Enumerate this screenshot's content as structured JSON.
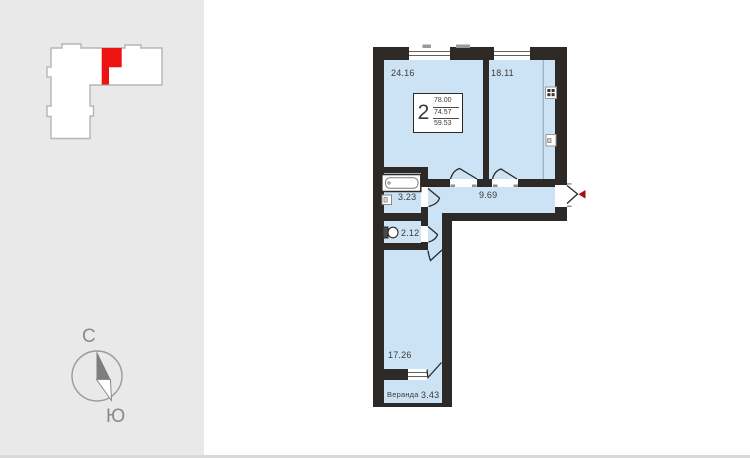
{
  "sidebar": {
    "compass": {
      "north": "С",
      "south": "Ю"
    }
  },
  "info_box": {
    "rooms_count": "2",
    "areas": [
      "78.00",
      "74.57",
      "59.53"
    ]
  },
  "rooms": {
    "living": "24.16",
    "kitchen": "18.11",
    "hall": "9.69",
    "bath": "3.23",
    "wc": "2.12",
    "bedroom": "17.26",
    "veranda_label": "Веранда",
    "veranda_area": "3.43"
  },
  "colors": {
    "wall": "#2d2926",
    "room_fill": "#cce3f6",
    "sidebar_bg": "#e9e9e9",
    "unit_highlight": "#ee1313",
    "entry_arrow": "#9e1212"
  }
}
